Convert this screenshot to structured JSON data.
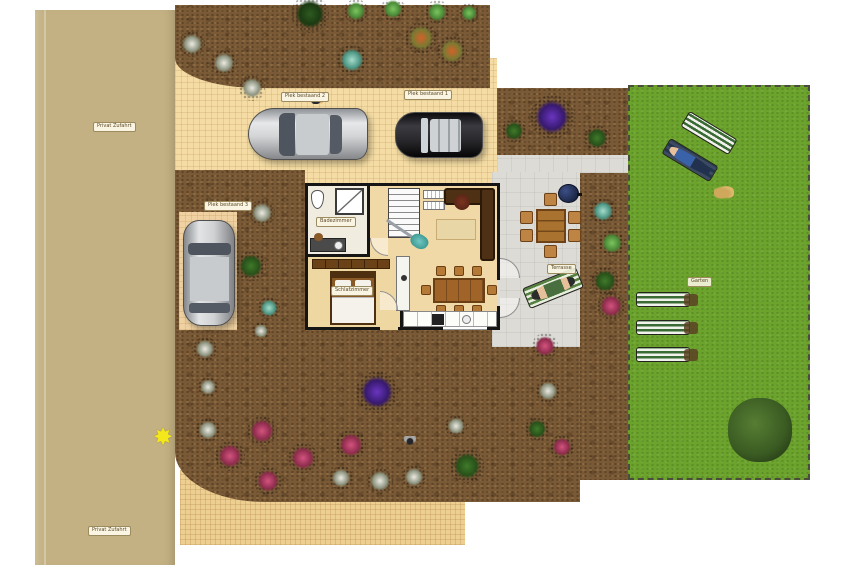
{
  "labels": {
    "road_top": "Privat Zufahrt",
    "road_bottom": "Privat Zufahrt",
    "parking_spot_1": "Plek bestaand 1",
    "parking_spot_2": "Plek bestaand 2",
    "parking_spot_3": "Plek bestaand 3",
    "bathroom": "Badezimmer",
    "bedroom": "Schlafzimmer",
    "terrace": "Terrasse",
    "garden": "Garten"
  },
  "colors": {
    "road": "#c4b183",
    "driveway": "#f4dca4",
    "bottom_paving": "#eecf92",
    "dirt": "#7a5a36",
    "lawn": "#6ba32c",
    "terrace": "#dcdbd6",
    "house_floor": "#f0d9a6",
    "wall": "#151515",
    "purple_bush": "#6a35c0",
    "pink_flowers": "#d4537e"
  },
  "icon_glyphs": {
    "star": "✸"
  },
  "garden_items": [
    {
      "t": "white",
      "x": 192,
      "y": 44,
      "s": 26
    },
    {
      "t": "white",
      "x": 224,
      "y": 63,
      "s": 26
    },
    {
      "t": "white",
      "x": 252,
      "y": 88,
      "s": 26
    },
    {
      "t": "darkgreen",
      "x": 310,
      "y": 14,
      "s": 38
    },
    {
      "t": "lightgreen",
      "x": 356,
      "y": 11,
      "s": 24
    },
    {
      "t": "lightgreen",
      "x": 393,
      "y": 9,
      "s": 24
    },
    {
      "t": "lightgreen",
      "x": 437,
      "y": 12,
      "s": 24
    },
    {
      "t": "lightgreen",
      "x": 469,
      "y": 13,
      "s": 20
    },
    {
      "t": "teal",
      "x": 352,
      "y": 60,
      "s": 30
    },
    {
      "t": "orange",
      "x": 421,
      "y": 38,
      "s": 32
    },
    {
      "t": "orange",
      "x": 452,
      "y": 51,
      "s": 30
    },
    {
      "t": "green",
      "x": 514,
      "y": 131,
      "s": 24
    },
    {
      "t": "purple",
      "x": 552,
      "y": 117,
      "s": 44
    },
    {
      "t": "green",
      "x": 597,
      "y": 138,
      "s": 26
    },
    {
      "t": "teal",
      "x": 603,
      "y": 211,
      "s": 26
    },
    {
      "t": "lightgreen",
      "x": 612,
      "y": 243,
      "s": 26
    },
    {
      "t": "green",
      "x": 605,
      "y": 281,
      "s": 28
    },
    {
      "t": "pink",
      "x": 611,
      "y": 306,
      "s": 28
    },
    {
      "t": "white",
      "x": 262,
      "y": 213,
      "s": 26
    },
    {
      "t": "green",
      "x": 251,
      "y": 266,
      "s": 30
    },
    {
      "t": "teal",
      "x": 269,
      "y": 308,
      "s": 22
    },
    {
      "t": "white",
      "x": 261,
      "y": 331,
      "s": 18
    },
    {
      "t": "white",
      "x": 205,
      "y": 349,
      "s": 24
    },
    {
      "t": "white",
      "x": 208,
      "y": 387,
      "s": 20
    },
    {
      "t": "purple",
      "x": 377,
      "y": 392,
      "s": 42
    },
    {
      "t": "white",
      "x": 208,
      "y": 430,
      "s": 24
    },
    {
      "t": "pink",
      "x": 262,
      "y": 431,
      "s": 30
    },
    {
      "t": "pink",
      "x": 230,
      "y": 456,
      "s": 30
    },
    {
      "t": "pink",
      "x": 268,
      "y": 481,
      "s": 28
    },
    {
      "t": "pink",
      "x": 303,
      "y": 458,
      "s": 30
    },
    {
      "t": "pink",
      "x": 351,
      "y": 445,
      "s": 30
    },
    {
      "t": "white",
      "x": 341,
      "y": 478,
      "s": 24
    },
    {
      "t": "white",
      "x": 380,
      "y": 481,
      "s": 26
    },
    {
      "t": "white",
      "x": 414,
      "y": 477,
      "s": 24
    },
    {
      "t": "bee",
      "x": 410,
      "y": 440,
      "s": 12,
      "h": 9
    },
    {
      "t": "white",
      "x": 456,
      "y": 426,
      "s": 22
    },
    {
      "t": "green",
      "x": 467,
      "y": 466,
      "s": 34
    },
    {
      "t": "pink",
      "x": 545,
      "y": 346,
      "s": 26
    },
    {
      "t": "white",
      "x": 548,
      "y": 391,
      "s": 24
    },
    {
      "t": "green",
      "x": 537,
      "y": 429,
      "s": 24
    },
    {
      "t": "pink",
      "x": 562,
      "y": 447,
      "s": 24
    },
    {
      "t": "star",
      "x": 163,
      "y": 438,
      "s": 26
    },
    {
      "t": "bird",
      "x": 317,
      "y": 99,
      "s": 12,
      "h": 9
    },
    {
      "t": "dog",
      "x": 724,
      "y": 192,
      "s": 20,
      "h": 13
    }
  ]
}
